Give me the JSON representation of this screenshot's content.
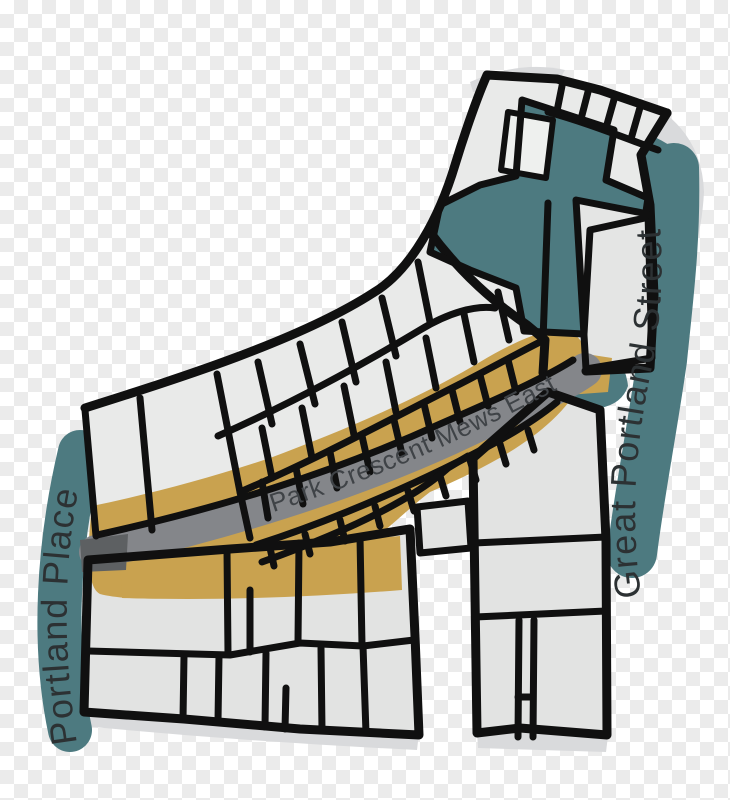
{
  "illustration": {
    "type": "hand-drawn street map",
    "background": "transparent checkerboard",
    "street_labels": {
      "left_vertical": "Portland Place",
      "right_vertical": "Great Portland Street",
      "curved_road": "Park Crescent Mews East"
    },
    "colors": {
      "teal": "#4d7a80",
      "road": "#84868a",
      "road_dark": "#5d6062",
      "mustard": "#c9a24f",
      "plot": "#e9eae9",
      "block": "#e2e3e2",
      "island": "#e4e5e4",
      "notch": "#eef0ee",
      "shadow": "#d9dadc",
      "ink": "#101010",
      "checker_light": "#ffffff",
      "checker_dark": "#ebebeb",
      "label_dark": "#2c3133",
      "road_label": "#3f4347"
    }
  }
}
